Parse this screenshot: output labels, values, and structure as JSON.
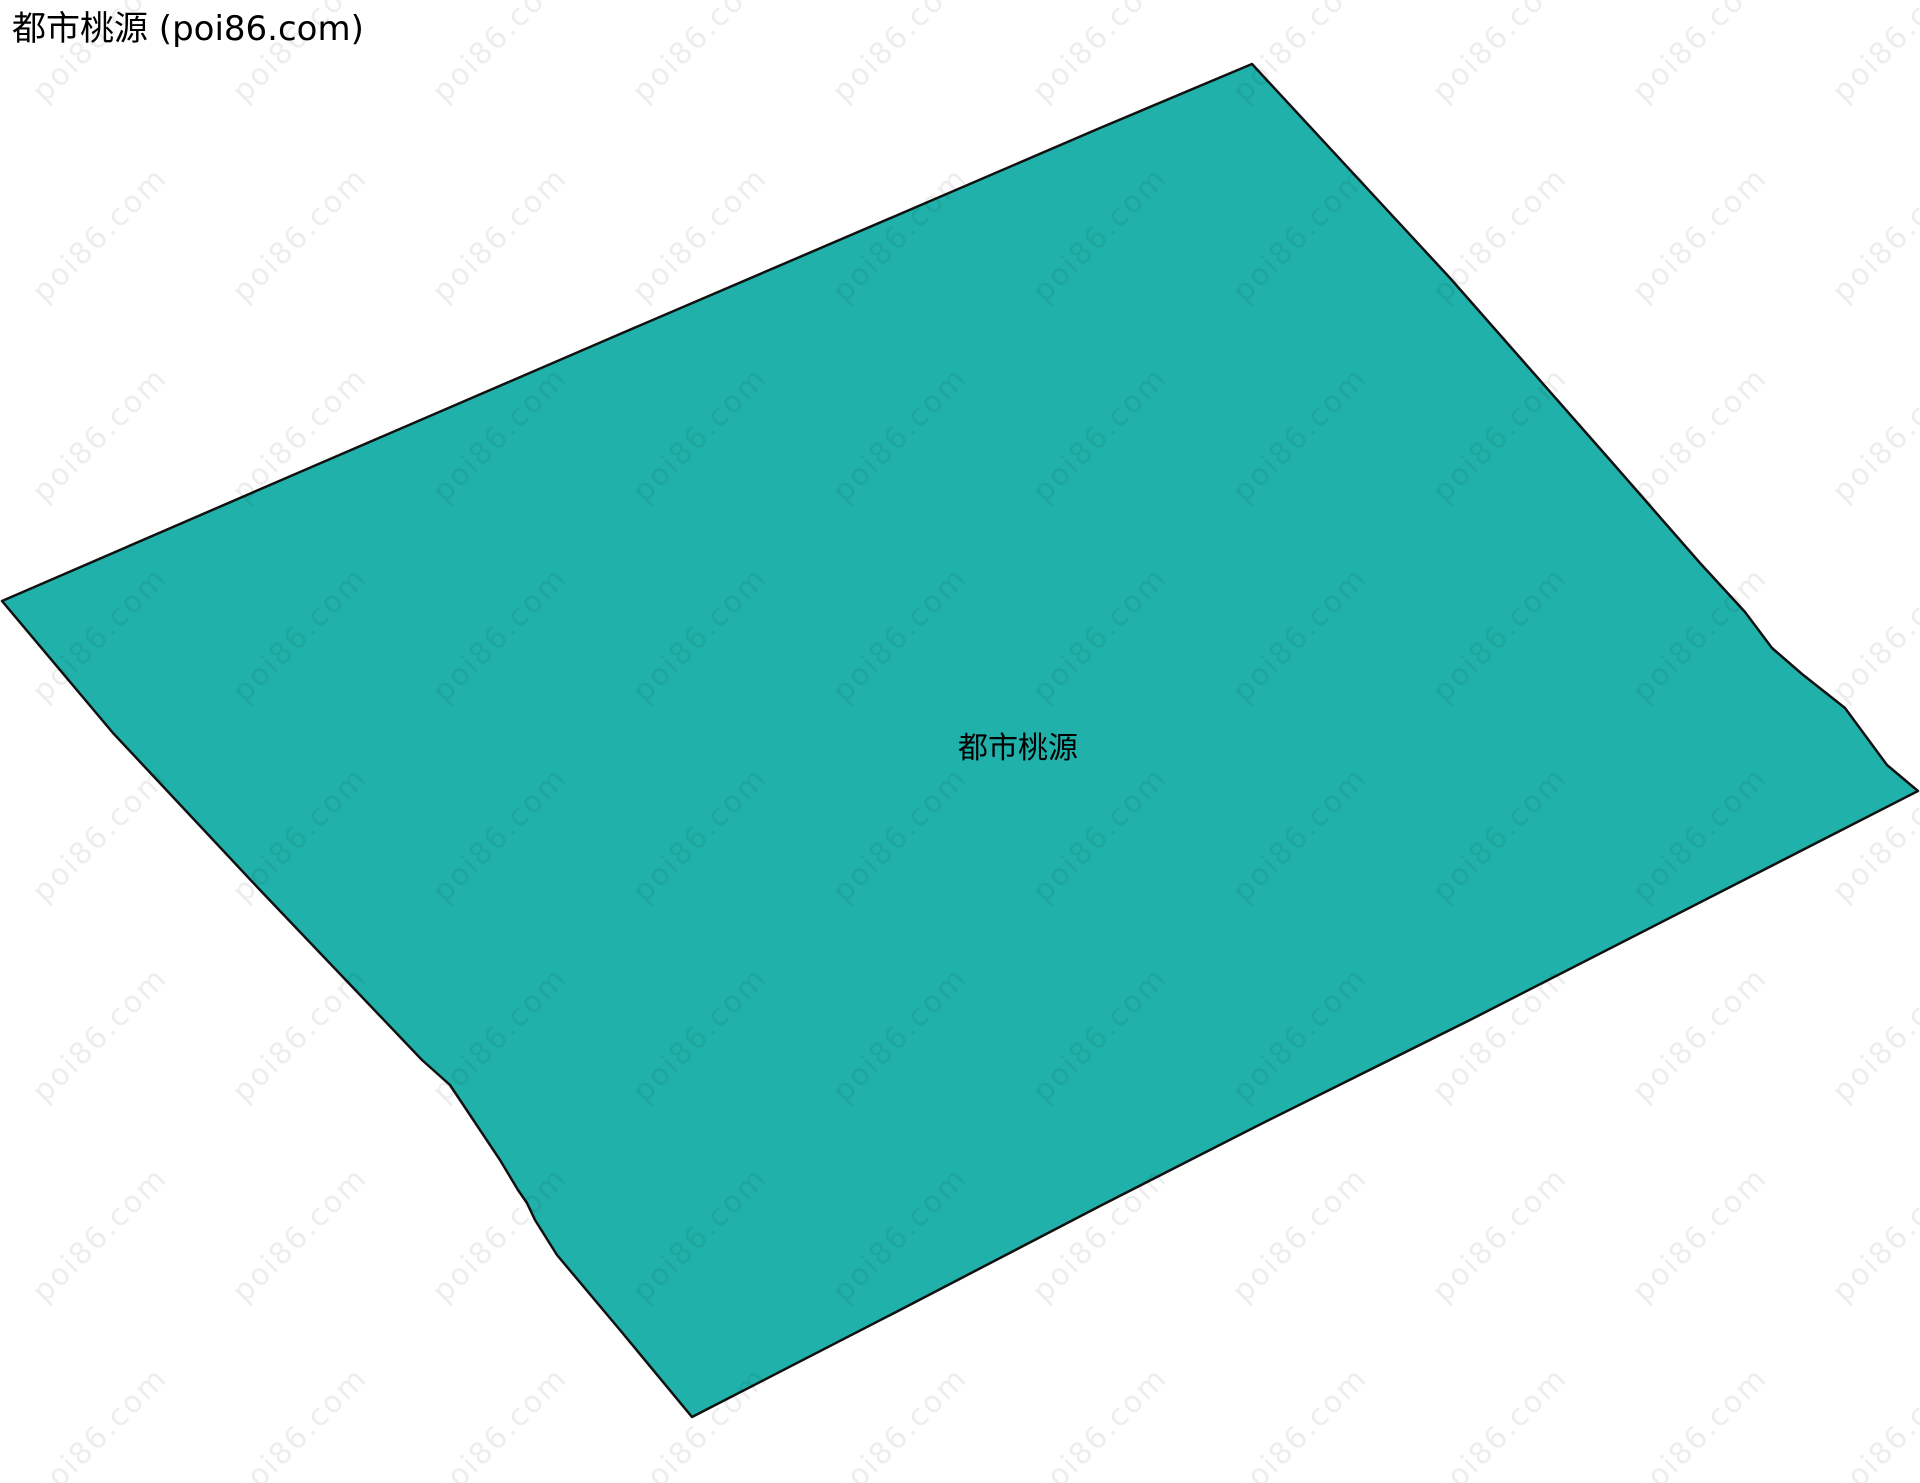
{
  "page": {
    "title": "都市桃源 (poi86.com)"
  },
  "map": {
    "region_label": "都市桃源",
    "fill_color": "#20B2AA",
    "stroke_color": "#111111",
    "background_color": "#ffffff",
    "polygon_points": "2,601 300,472 620,334 900,214 1100,128 1252,64 1450,278 1610,460 1700,563 1745,612 1772,648 1802,674 1845,708 1887,765 1918,791 1470,1020 1257,1126 1100,1206 900,1310 692,1417 620,1330 557,1255 535,1220 527,1203 518,1190 500,1160 450,1085 422,1060 260,890 113,733"
  },
  "watermark": {
    "text": "poi86.com",
    "color": "rgba(0,0,0,0.07)",
    "rotation_deg": -45,
    "font_size": 30,
    "origin_x": -100,
    "origin_y": -165,
    "spacing_x": 200,
    "spacing_y": 200,
    "cols": 11,
    "rows": 9
  }
}
